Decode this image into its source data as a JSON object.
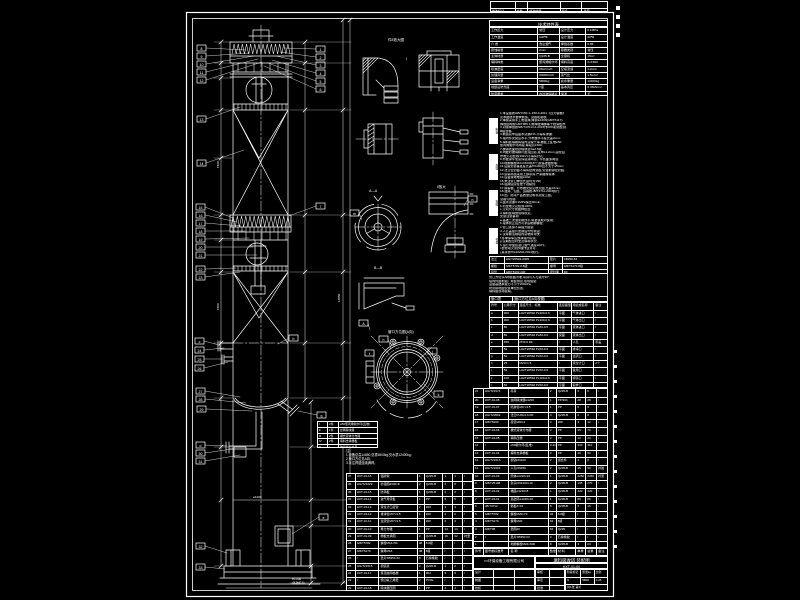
{
  "sheet": {
    "bg": "#000000",
    "line": "#ffffff"
  },
  "revision_strip": {
    "rows": [
      [
        "",
        "",
        "",
        "",
        ""
      ],
      [
        "修改标记",
        "处数",
        "修改依据",
        "签名",
        "日期"
      ]
    ]
  },
  "characteristics": {
    "title": "技术特性表",
    "rows": [
      [
        "工作压力",
        "常压",
        "设计压力",
        "0.1MPa"
      ],
      [
        "工作温度",
        "≤40℃",
        "设计温度",
        "60℃"
      ],
      [
        "介  质",
        "含尘烟气",
        "焊缝系数",
        "0.85"
      ],
      [
        "腐蚀裕量",
        "2mm",
        "容器类别",
        "常压"
      ],
      [
        "主体材质",
        "Q235-B",
        "全容积",
        "15m³"
      ],
      [
        "填料种类",
        "聚丙烯鲍尔环",
        "填料高度",
        "2×1500"
      ],
      [
        "喷淋密度",
        "25m³/m²h",
        "空塔流速",
        "1.2m/s"
      ],
      [
        "处理风量",
        "30000m³/h",
        "液气比",
        "1.5L/m³"
      ],
      [
        "设备净重",
        "5800kg",
        "充水重量",
        "12400kg"
      ],
      [
        "地震设防烈度",
        "7度",
        "基本风压",
        "0.45kN/m²"
      ],
      [
        "防腐要求",
        "内衬玻璃鳞片",
        "保温",
        "无"
      ]
    ]
  },
  "requirements": {
    "tabs": [
      "制造",
      "焊接",
      "检验",
      "衬里"
    ],
    "lines": [
      "1.本设备按GB/T150.1~150.4-2011《压力容器》",
      "  及本图技术要求制造、试验和验收;",
      "2.焊接采用手工电弧焊,焊条E4303(GB/T5117),",
      "  焊缝结构按GB/T985.1,角焊缝焊脚等于较薄板厚;",
      "3.对接焊缝按NB/T47013.2-2015作20%射线检测,",
      "  Ⅲ级合格;",
      "4.制造完毕后盛水试漏24h,不得有渗漏;",
      "5.塔内件安装应水平,分布器水平度允差2mm;",
      "6.填料装填前将塔内清理干净,栅板上乱堆⌀50",
      "  聚丙烯鲍尔环两段,每段高1500;",
      "7.碳钢表面喷砂除锈至Sa2.5级;",
      "8.内壁衬玻璃鳞片胶泥四道,总厚≥1.2mm,固化后",
      "  作电火花检测(15kV)不得有针孔;",
      "9.外壁涂环氧富锌底漆两道、环氧面漆两道;",
      "10.地脚螺栓M24×600共8个,按基础图预埋;",
      "11.设备安装垂直度允差H/1000且不大于15mm;",
      "12.法兰密封面不得有径向划痕,安装前涂密封脂;",
      "13.运输吊装采用上部吊耳,严禁碰撞塔体;",
      "14.设备接地电阻≤10Ω;",
      "15.未注管口伸出长度均为150;",
      "16.铭牌固定在便于观察处;",
      "17.除雾器、分布器安装见放大图,允差±3mm;",
      "18.油漆、包装、运输按JB/T4711-2003执行;",
      "19.出厂随带产品质量证明书及竣工图。",
      "试验与检验:",
      "a.盛水试漏0.1MPa保压30min;",
      "b.衬里电火花检测100%;",
      "c.几何尺寸按图样检查;",
      "d.填料装填量现场核定。",
      "安装注意事项:",
      "a.基础二次灌浆前找平,斜垫铁成对使用;",
      "b.塔体找正后方可紧固地脚螺栓;",
      "c.管口连接不得强力组装;",
      "d.人孔盖垫片更换后均匀紧固;",
      "e.试车前清除塔内杂物并冲洗;",
      "f.冬季停车应放净塔内存液;",
      "g.定期检查衬里及填料状况;",
      "h.运行中监控进口烟气温度≤60℃;",
      "i.检修动火须办理作业许可;",
      "j.其余按HG20202-2014执行。"
    ],
    "lines2": [
      "管口方位以A向视图为准,吊耳与人孔错开90°;",
      "塔内件由制造厂成套供货,现场组装;",
      "设备基础承载力不小于200kPa;",
      "防雷接地由安装单位负责;",
      "填料由现场装填。"
    ]
  },
  "flange_std": {
    "rows": [
      [
        "法兰",
        "HG/T20592-2009",
        "垫片",
        "XB350 δ3"
      ],
      [
        "螺栓",
        "GB/T5782 8.8级",
        "螺母",
        "GB/T6170 8级"
      ],
      [
        "接管",
        "GB/T8163 20#",
        "密封面",
        "RF"
      ]
    ]
  },
  "nozzles": {
    "title_row": [
      [
        "管口表",
        "(管口方位见A向视图)"
      ]
    ],
    "rows": [
      [
        "符号",
        "公称尺寸",
        "连接尺寸、标准",
        "连接面型式",
        "用途或名称",
        "备注"
      ],
      [
        "a",
        "300",
        "HG/T20592 PL300-0.6",
        "平面",
        "气体进口",
        "/"
      ],
      [
        "b",
        "300",
        "HG/T20592 PL300-0.6",
        "平面",
        "气体出口",
        "/"
      ],
      [
        "c",
        "80",
        "HG/T20592 PL80-0.6",
        "平面",
        "液体进口",
        "/"
      ],
      [
        "d",
        "80",
        "HG/T20592 PL80-0.6",
        "突面",
        "液体出口",
        "/"
      ],
      [
        "e",
        "450",
        "PN0.6 RF",
        "/",
        "人孔",
        "带盖"
      ],
      [
        "f",
        "50",
        "HG/T20592 PL50-0.6",
        "平面",
        "排净口",
        "/"
      ],
      [
        "g",
        "50",
        "HG/T20592 PL50-0.6",
        "平面",
        "溢流口",
        "/"
      ],
      [
        "h",
        "25",
        "M20×1.5",
        "/",
        "液位计口",
        "2个"
      ],
      [
        "j",
        "50",
        "HG/T20592 PL50-0.6",
        "平面",
        "备用口",
        "/"
      ],
      [
        "k",
        "100",
        "HG/T20592 PL100-0.6",
        "平面",
        "视镜口",
        "/"
      ],
      [
        "l",
        "50",
        "HG/T20592 PL50-0.6",
        "平面",
        "取样口",
        "/"
      ]
    ]
  },
  "bom_header": [
    "件号",
    "图号或标准号",
    "名  称",
    "数量",
    "材  料",
    "单重",
    "总重",
    "备注"
  ],
  "bom_right": {
    "rows": [
      [
        "21",
        "HG/T21574",
        "吊耳",
        "2",
        "Q235-B",
        "3",
        "6",
        "/"
      ],
      [
        "20",
        "HXT-01-08",
        "丝网除沫器⌀1200",
        "1",
        "PP/304",
        "28",
        "28",
        "/"
      ],
      [
        "19",
        "HXT-01-07",
        "喷淋管⌀57×3.5",
        "1",
        "PP",
        "6",
        "6",
        "/"
      ],
      [
        "18",
        "HG/T20592",
        "法兰PL80-0.6 RF",
        "4",
        "Q235-B",
        "2",
        "8",
        "/"
      ],
      [
        "17",
        "GB/T8163",
        "接管⌀89×4",
        "4",
        "20#",
        "3",
        "12",
        "/"
      ],
      [
        "16",
        "HXT-01-06",
        "槽式液体分布器",
        "2",
        "PP",
        "35",
        "70",
        "/"
      ],
      [
        "15",
        "HXT-01-05",
        "填料压栅",
        "2",
        "PP",
        "12",
        "24",
        "/"
      ],
      [
        "14",
        "/",
        "⌀50鲍尔环(乱堆)",
        "3.4m³",
        "PP",
        "310",
        "310",
        "/"
      ],
      [
        "13",
        "HXT-01-04",
        "填料支承栅板",
        "2",
        "PP",
        "26",
        "52",
        "/"
      ],
      [
        "12",
        "HG/T21515",
        "视镜DN100",
        "2",
        "组合件",
        "4",
        "8",
        "/"
      ],
      [
        "11",
        "HG/T21594",
        "人孔DN450",
        "2",
        "Q235-B",
        "45",
        "90",
        "衬胶"
      ],
      [
        "10",
        "HXT-01-03",
        "筒体⌀1220×10",
        "1",
        "Q235-B",
        "2260",
        "2260",
        "衬里"
      ],
      [
        "9",
        "GB/T25198",
        "封头DN1200×10",
        "2",
        "Q235-B",
        "135",
        "270",
        "/"
      ],
      [
        "8",
        "HXT-01-02",
        "裙座⌀1220×8",
        "1",
        "Q235-B",
        "420",
        "420",
        "/"
      ],
      [
        "7",
        "HXT-01-01",
        "基础环⌀1420×16",
        "1",
        "Q235-B",
        "86",
        "86",
        "/"
      ],
      [
        "6",
        "JB/T4712",
        "筋板δ=10",
        "8",
        "Q235-B",
        "2",
        "16",
        "/"
      ],
      [
        "5",
        "GB/T5782",
        "螺栓M20×70",
        "32",
        "8.8级",
        "/",
        "/",
        "/"
      ],
      [
        "4",
        "GB/T6170",
        "螺母M20",
        "64",
        "8级",
        "/",
        "/",
        "/"
      ],
      [
        "3",
        "GB/T95",
        "垫圈20",
        "64",
        "Q235",
        "/",
        "/",
        "/"
      ],
      [
        "2",
        "/",
        "垫片XB350 δ3",
        "4",
        "石棉橡胶",
        "/",
        "/",
        "/"
      ],
      [
        "1",
        "/",
        "地脚螺栓M24×600",
        "8",
        "Q235-B",
        "3",
        "24",
        "/"
      ]
    ]
  },
  "bom_left": {
    "rows": [
      [
        "37",
        "HXT-01-16",
        "铭牌架",
        "1",
        "Q235-B",
        "1",
        "1",
        "/"
      ],
      [
        "36",
        "HG/T21629",
        "补强圈d340×8",
        "2",
        "Q235-B",
        "4",
        "8",
        "/"
      ],
      [
        "35",
        "HXT-01-15",
        "防涡板",
        "1",
        "Q235-B",
        "2",
        "2",
        "/"
      ],
      [
        "34",
        "HXT-01-14",
        "进气导流板",
        "1",
        "PP",
        "5",
        "5",
        "/"
      ],
      [
        "33",
        "HXT-01-13",
        "液位计口接管",
        "2",
        "20#",
        "2",
        "4",
        "/"
      ],
      [
        "32",
        "HXT-01-12",
        "排净管⌀57×3.5",
        "1",
        "20#",
        "2",
        "2",
        "/"
      ],
      [
        "31",
        "HXT-01-11",
        "溢流管⌀57×3.5",
        "1",
        "20#",
        "3",
        "3",
        "/"
      ],
      [
        "30",
        "HXT-01-10",
        "再分布锥",
        "1",
        "PP",
        "14",
        "14",
        "/"
      ],
      [
        "29",
        "HXT-01-09",
        "栅板支承圈",
        "2",
        "Q235-B",
        "16",
        "32",
        "衬里"
      ],
      [
        "28",
        "GB/T5782",
        "螺栓M16×50",
        "48",
        "8.8级",
        "/",
        "/",
        "/"
      ],
      [
        "27",
        "GB/T6170",
        "螺母M16",
        "48",
        "8级",
        "/",
        "/",
        "/"
      ],
      [
        "26",
        "/",
        "垫片XB350 δ3",
        "8",
        "石棉橡胶",
        "/",
        "/",
        "/"
      ],
      [
        "25",
        "HG/T21515",
        "视镜罩",
        "2",
        "Q235-B",
        "1",
        "2",
        "/"
      ],
      [
        "24",
        "HXT-01-17",
        "塔顶丝网格栅",
        "1",
        "304",
        "9",
        "9",
        "/"
      ],
      [
        "23",
        "/",
        "聚四氟乙烯垫",
        "2",
        "PTFE",
        "/",
        "/",
        "/"
      ],
      [
        "22",
        "HXT-01-18",
        "除沫器压圈",
        "1",
        "PP",
        "4",
        "4",
        "/"
      ]
    ]
  },
  "title_block": {
    "company": "××环保设备工程有限公司",
    "title": "填料吸收塔 装配图",
    "code": "HXT-01-00",
    "left_rows": [
      [
        "设计",
        "",
        ""
      ],
      [
        "制图",
        "",
        ""
      ],
      [
        "校核",
        "",
        ""
      ]
    ],
    "mid_rows": [
      [
        "审核",
        ""
      ],
      [
        "审定",
        ""
      ],
      [
        "批准",
        ""
      ]
    ],
    "right_header": [
      "阶段标记",
      "质量kg",
      "比例"
    ],
    "right_values": [
      "S",
      "5800",
      "1:25"
    ],
    "sheet_info": "共1张 第1张"
  },
  "legend": {
    "rows": [
      [
        "Ⅰ",
        "2件",
        "⌀50聚丙烯鲍尔环(乱堆)"
      ],
      [
        "Ⅱ",
        "1件",
        "丝网除沫器"
      ],
      [
        "Ⅲ",
        "2件",
        "槽式液体分布器"
      ],
      [
        "Ⅳ",
        "2件",
        "填料支承栅板"
      ],
      [
        "Ⅴ",
        "/",
        "玻璃鳞片衬里"
      ]
    ]
  },
  "notes": {
    "title": "注:",
    "lines": [
      "1.设备总高14850,总重5800kg,充水重12400kg;",
      "2.管口方位见A向;",
      "3.未注焊缝连续满焊。"
    ]
  },
  "svg_labels": [
    {
      "t": "件8放大图",
      "x": 388,
      "y": 41,
      "s": 3.5
    },
    {
      "t": "Ⅰ",
      "x": 406,
      "y": 60,
      "s": 3.5
    },
    {
      "t": "A—A",
      "x": 369,
      "y": 192,
      "s": 3.5
    },
    {
      "t": "Ⅱ放大",
      "x": 437,
      "y": 188,
      "s": 3.5
    },
    {
      "t": "B—B",
      "x": 374,
      "y": 269,
      "s": 3.5
    },
    {
      "t": "管口方位图(A向)",
      "x": 388,
      "y": 333,
      "s": 3.5
    },
    {
      "t": "±0.000",
      "x": 292,
      "y": 580,
      "s": 3
    },
    {
      "t": "(基础标高)",
      "x": 292,
      "y": 584,
      "s": 2.8
    },
    {
      "t": "14850",
      "x": 340,
      "y": 302,
      "s": 3,
      "r": -90
    },
    {
      "t": "⌀1200",
      "x": 253,
      "y": 498,
      "s": 3
    },
    {
      "t": "1500",
      "x": 219,
      "y": 168,
      "s": 3,
      "r": -90
    },
    {
      "t": "1500",
      "x": 219,
      "y": 310,
      "s": 3,
      "r": -90
    }
  ],
  "callouts": [
    {
      "x": 197,
      "y": 45,
      "t": "8",
      "lx": 246,
      "ly": 50
    },
    {
      "x": 197,
      "y": 53,
      "t": "9",
      "lx": 250,
      "ly": 53
    },
    {
      "x": 197,
      "y": 61,
      "t": "10",
      "lx": 254,
      "ly": 56
    },
    {
      "x": 197,
      "y": 69,
      "t": "11",
      "lx": 258,
      "ly": 59
    },
    {
      "x": 197,
      "y": 77,
      "t": "12",
      "lx": 262,
      "ly": 62
    },
    {
      "x": 197,
      "y": 116,
      "t": "13",
      "lx": 240,
      "ly": 107
    },
    {
      "x": 197,
      "y": 160,
      "t": "14",
      "lx": 244,
      "ly": 150
    },
    {
      "x": 196,
      "y": 204,
      "t": "15",
      "lx": 233,
      "ly": 218
    },
    {
      "x": 196,
      "y": 212,
      "t": "16",
      "lx": 237,
      "ly": 222
    },
    {
      "x": 196,
      "y": 220,
      "t": "17",
      "lx": 241,
      "ly": 226
    },
    {
      "x": 196,
      "y": 228,
      "t": "18",
      "lx": 245,
      "ly": 231
    },
    {
      "x": 196,
      "y": 236,
      "t": "19",
      "lx": 249,
      "ly": 238
    },
    {
      "x": 196,
      "y": 244,
      "t": "20",
      "lx": 253,
      "ly": 247
    },
    {
      "x": 196,
      "y": 252,
      "t": "21",
      "lx": 257,
      "ly": 255
    },
    {
      "x": 196,
      "y": 266,
      "t": "22",
      "lx": 236,
      "ly": 268
    },
    {
      "x": 196,
      "y": 274,
      "t": "23",
      "lx": 240,
      "ly": 272
    },
    {
      "x": 195,
      "y": 338,
      "t": "c",
      "lx": 219,
      "ly": 345
    },
    {
      "x": 195,
      "y": 347,
      "t": "24",
      "lx": 224,
      "ly": 348
    },
    {
      "x": 195,
      "y": 356,
      "t": "25",
      "lx": 222,
      "ly": 359
    },
    {
      "x": 195,
      "y": 365,
      "t": "26",
      "lx": 228,
      "ly": 362
    },
    {
      "x": 196,
      "y": 388,
      "t": "27",
      "lx": 240,
      "ly": 397
    },
    {
      "x": 196,
      "y": 396,
      "t": "28",
      "lx": 246,
      "ly": 403
    },
    {
      "x": 197,
      "y": 406,
      "t": "29",
      "lx": 252,
      "ly": 411
    },
    {
      "x": 196,
      "y": 442,
      "t": "d",
      "lx": 227,
      "ly": 446
    },
    {
      "x": 196,
      "y": 450,
      "t": "30",
      "lx": 232,
      "ly": 449
    },
    {
      "x": 196,
      "y": 458,
      "t": "31",
      "lx": 240,
      "ly": 455
    },
    {
      "x": 196,
      "y": 543,
      "t": "32",
      "lx": 227,
      "ly": 553
    },
    {
      "x": 196,
      "y": 564,
      "t": "33",
      "lx": 225,
      "ly": 569
    },
    {
      "x": 316,
      "y": 46,
      "t": "1",
      "lx": 284,
      "ly": 48
    },
    {
      "x": 316,
      "y": 54,
      "t": "2",
      "lx": 280,
      "ly": 52
    },
    {
      "x": 316,
      "y": 62,
      "t": "3",
      "lx": 276,
      "ly": 56
    },
    {
      "x": 316,
      "y": 70,
      "t": "4",
      "lx": 272,
      "ly": 60
    },
    {
      "x": 316,
      "y": 78,
      "t": "5",
      "lx": 268,
      "ly": 63
    },
    {
      "x": 316,
      "y": 86,
      "t": "6",
      "lx": 264,
      "ly": 66
    },
    {
      "x": 316,
      "y": 203,
      "t": "7",
      "lx": 289,
      "ly": 216
    },
    {
      "x": 289,
      "y": 335,
      "t": "b",
      "lx": 278,
      "ly": 344
    },
    {
      "x": 317,
      "y": 412,
      "t": "g",
      "lx": 298,
      "ly": 411
    },
    {
      "x": 319,
      "y": 514,
      "t": "e",
      "lx": 292,
      "ly": 534
    },
    {
      "x": 359,
      "y": 320,
      "t": "A",
      "lx": 370,
      "ly": 330
    },
    {
      "x": 379,
      "y": 336,
      "t": "h",
      "lx": 391,
      "ly": 349
    },
    {
      "x": 428,
      "y": 348,
      "t": "j",
      "lx": 420,
      "ly": 358
    },
    {
      "x": 434,
      "y": 391,
      "t": "k",
      "lx": 424,
      "ly": 384
    },
    {
      "x": 365,
      "y": 350,
      "t": "f",
      "lx": 374,
      "ly": 361
    },
    {
      "x": 350,
      "y": 210,
      "t": "m",
      "lx": 362,
      "ly": 220
    },
    {
      "x": 468,
      "y": 196,
      "t": "n",
      "lx": 464,
      "ly": 206
    }
  ]
}
